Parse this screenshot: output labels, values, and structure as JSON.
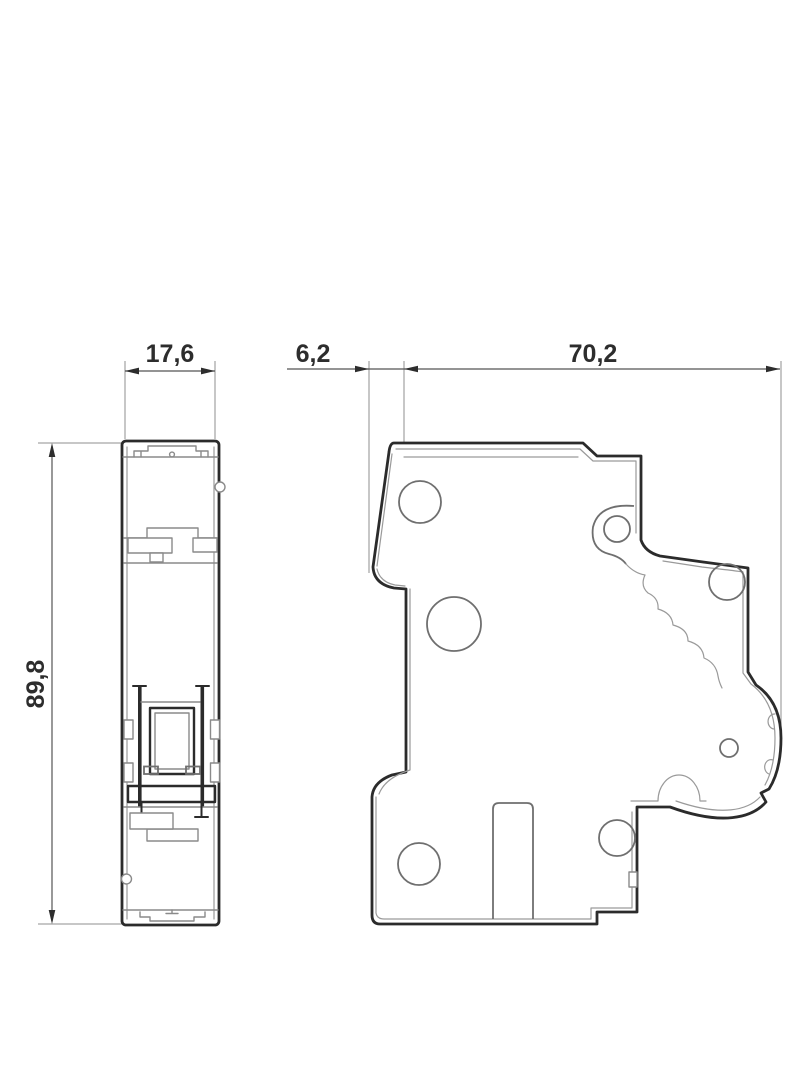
{
  "drawing": {
    "type": "technical-dimension-drawing",
    "subject": "circuit-breaker-two-view-outline",
    "views": [
      {
        "name": "front-view"
      },
      {
        "name": "side-view"
      }
    ],
    "dimensions": {
      "front_width": {
        "label": "17,6",
        "orientation": "horizontal"
      },
      "front_height": {
        "label": "89,8",
        "orientation": "vertical"
      },
      "side_offset": {
        "label": "6,2",
        "orientation": "horizontal"
      },
      "side_depth": {
        "label": "70,2",
        "orientation": "horizontal"
      }
    },
    "colors": {
      "outline": "#2b2b2b",
      "detail": "#8a8a8a",
      "dimension": "#555555",
      "text": "#2d2d2d",
      "background": "#ffffff"
    }
  }
}
